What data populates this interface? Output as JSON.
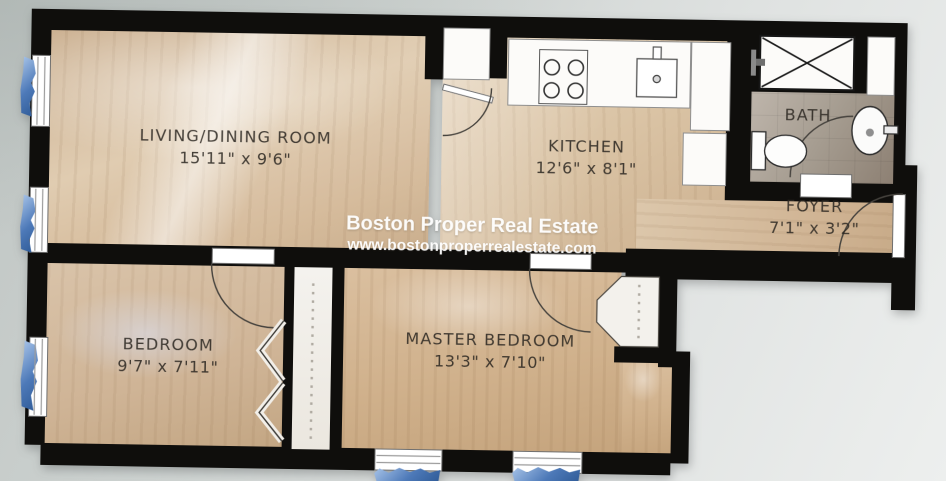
{
  "watermark": {
    "line1": "Boston Proper Real Estate",
    "line2": "www.bostonproperrealestate.com"
  },
  "rooms": {
    "living_dining": {
      "name": "LIVING/DINING ROOM",
      "dims": "15'11\" x 9'6\""
    },
    "kitchen": {
      "name": "KITCHEN",
      "dims": "12'6\" x 8'1\""
    },
    "bath": {
      "name": "BATH"
    },
    "foyer": {
      "name": "FOYER",
      "dims": "7'1\" x 3'2\""
    },
    "bedroom": {
      "name": "BEDROOM",
      "dims": "9'7\" x 7'11\""
    },
    "master_bedroom": {
      "name": "MASTER BEDROOM",
      "dims": "13'3\" x 7'10\""
    }
  },
  "colors": {
    "wall": "#0f0e0c",
    "wood_floor": "#d5bb9e",
    "tile_floor": "#a59c90",
    "window_accent_blue": "#4d79b8",
    "background": "#cdd2d1",
    "watermark_text": "#ffffff",
    "label_text": "#38342e"
  }
}
